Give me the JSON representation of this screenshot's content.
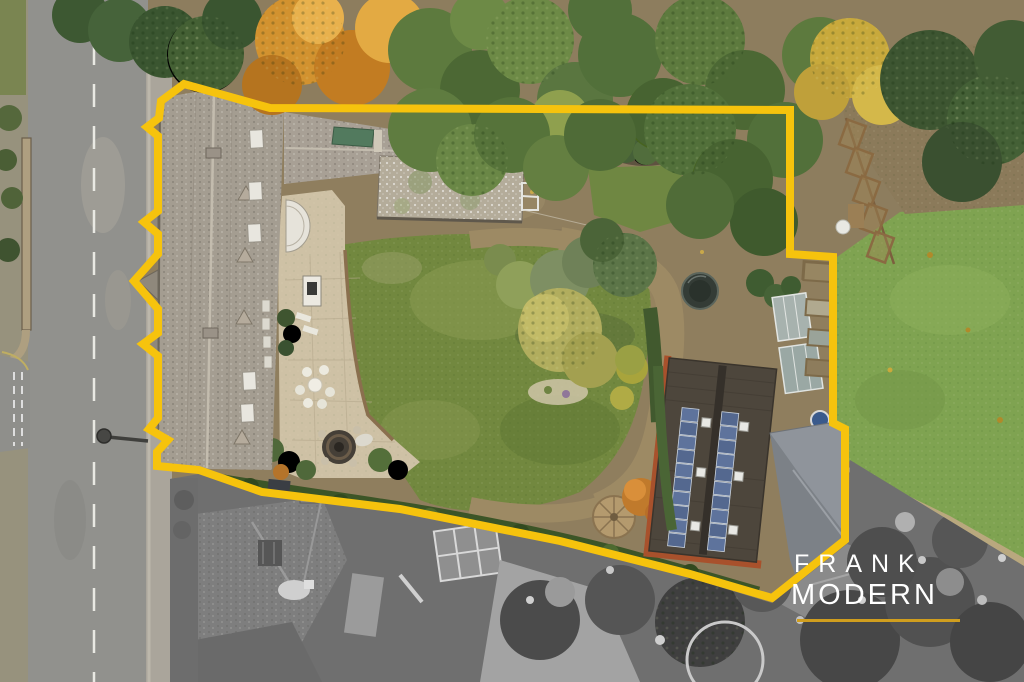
{
  "branding": {
    "line1": "FRANK",
    "line2": "MODERN"
  },
  "colors": {
    "boundary_line": "#F6C30D",
    "logo_text": "#FFFFFF",
    "logo_underline": "#D09E1E"
  }
}
